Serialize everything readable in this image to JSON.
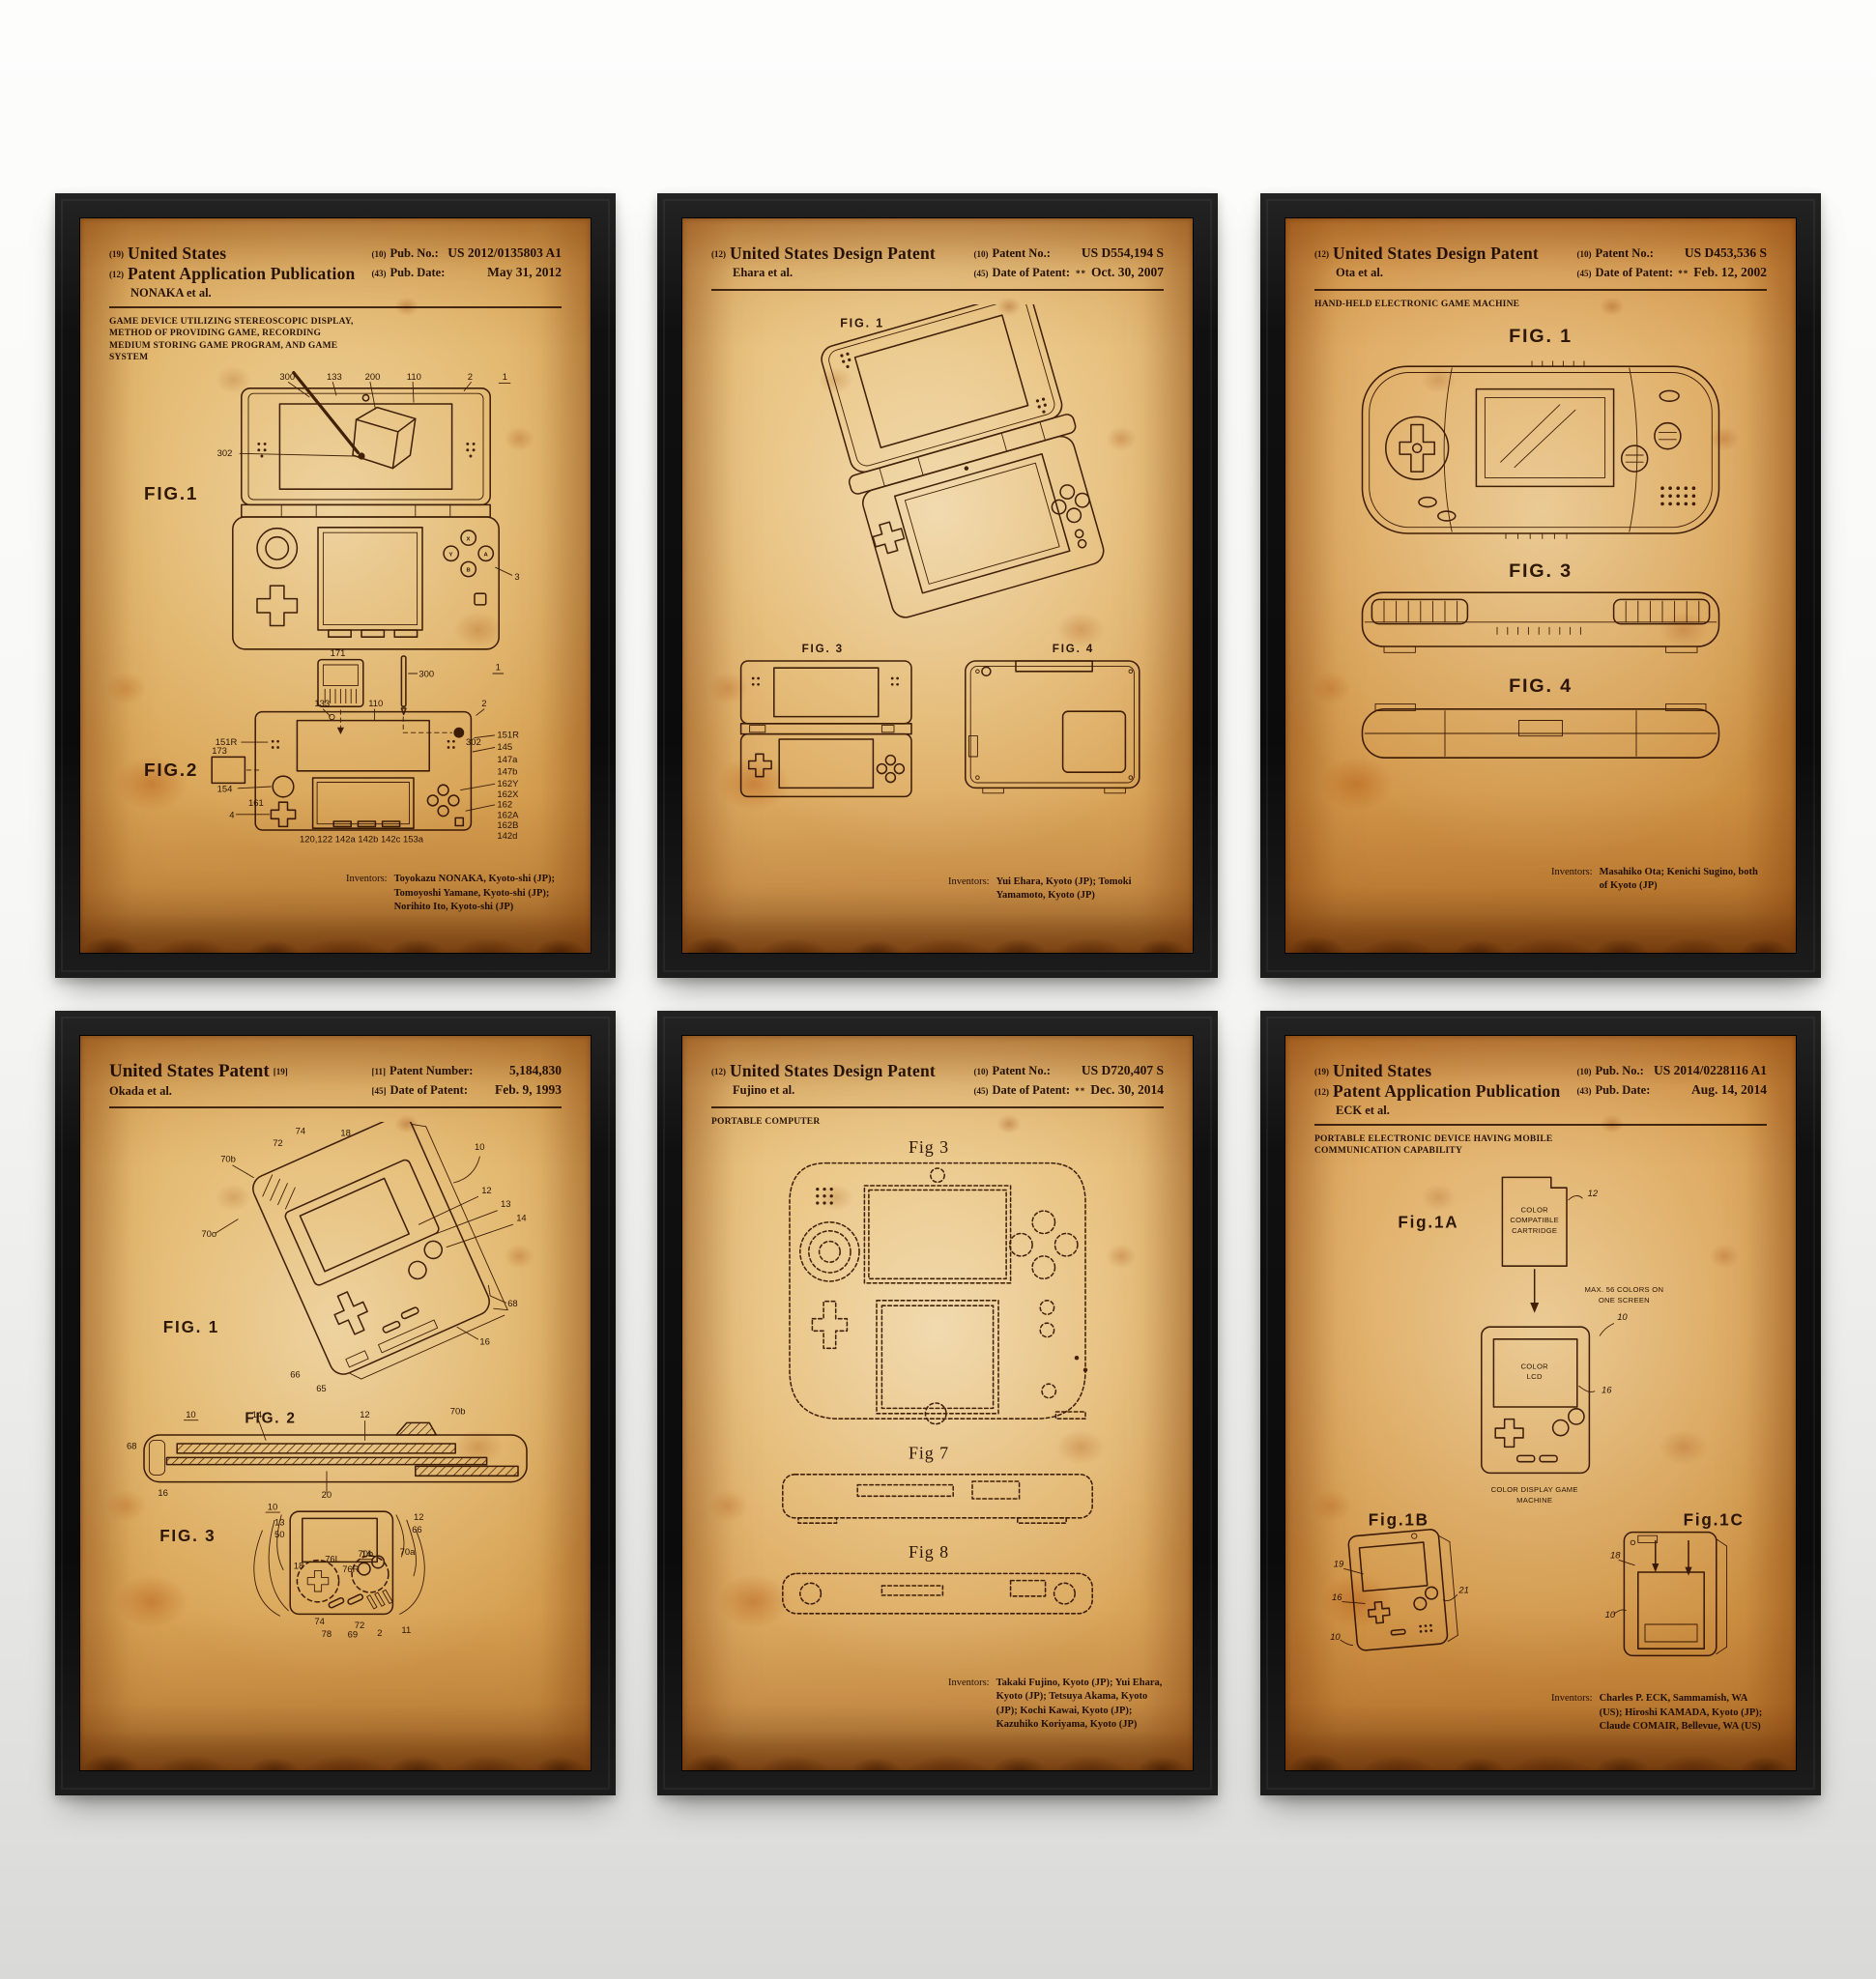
{
  "frames": [
    {
      "name": "nintendo-3ds-patent",
      "header": {
        "n1": "(19)",
        "t1": "United States",
        "n2": "(12)",
        "t2": "Patent Application Publication",
        "party": "NONAKA et al.",
        "rn1": "(10)",
        "rl1": "Pub. No.:",
        "rv1": "US 2012/0135803 A1",
        "rn2": "(43)",
        "rl2": "Pub. Date:",
        "rv2": "May 31, 2012"
      },
      "title": "GAME DEVICE UTILIZING STEREOSCOPIC DISPLAY, METHOD OF PROVIDING GAME, RECORDING MEDIUM STORING GAME PROGRAM, AND GAME SYSTEM",
      "figs": {
        "f1": "FIG.1",
        "f2": "FIG.2"
      },
      "refs": {
        "r300": "300",
        "r133": "133",
        "r200": "200",
        "r110": "110",
        "r2": "2",
        "r1": "1",
        "r302": "302",
        "r3": "3",
        "r171": "171",
        "r173": "173",
        "r161": "161",
        "r154": "154",
        "r4": "4",
        "r151R": "151R",
        "r145": "145",
        "r147a": "147a",
        "r147b": "147b",
        "r162Y": "162Y",
        "r162X": "162X",
        "r162": "162",
        "r162A": "162A",
        "r162B": "162B",
        "r142": "142",
        "r142d": "142d",
        "rrow": "120,122   142a   142b   142c   153a",
        "bx": "X",
        "by": "Y",
        "ba": "A",
        "bb": "B"
      },
      "inv_label": "Inventors:",
      "inventors": "Toyokazu NONAKA, Kyoto-shi (JP); Tomoyoshi Yamane, Kyoto-shi (JP); Norihito Ito, Kyoto-shi (JP)"
    },
    {
      "name": "nintendo-ds-lite-patent",
      "header": {
        "n1": "(12)",
        "t1": "United States Design Patent",
        "party": "Ehara et al.",
        "rn1": "(10)",
        "rl1": "Patent No.:",
        "rv1": "US D554,194 S",
        "rn2": "(45)",
        "rl2": "Date of Patent:",
        "rpre": "**",
        "rv2": "Oct. 30, 2007"
      },
      "figs": {
        "f1": "FIG. 1",
        "f3": "FIG. 3",
        "f4": "FIG. 4"
      },
      "inv_label": "Inventors:",
      "inventors": "Yui Ehara, Kyoto (JP); Tomoki Yamamoto, Kyoto (JP)"
    },
    {
      "name": "game-boy-advance-patent",
      "header": {
        "n1": "(12)",
        "t1": "United States Design Patent",
        "party": "Ota et al.",
        "rn1": "(10)",
        "rl1": "Patent No.:",
        "rv1": "US D453,536 S",
        "rn2": "(45)",
        "rl2": "Date of Patent:",
        "rpre": "**",
        "rv2": "Feb. 12, 2002"
      },
      "title": "HAND-HELD ELECTRONIC GAME MACHINE",
      "figs": {
        "f1": "FIG. 1",
        "f3": "FIG. 3",
        "f4": "FIG. 4"
      },
      "inv_label": "Inventors:",
      "inventors": "Masahiko Ota; Kenichi Sugino, both of Kyoto (JP)"
    },
    {
      "name": "game-boy-patent",
      "header": {
        "t1": "United States Patent",
        "n1": "[19]",
        "party": "Okada et al.",
        "rn1": "[11]",
        "rl1": "Patent Number:",
        "rv1": "5,184,830",
        "rn2": "[45]",
        "rl2": "Date of Patent:",
        "rv2": "Feb. 9, 1993"
      },
      "figs": {
        "f1": "FIG. 1",
        "f2": "FIG. 2",
        "f3": "FIG. 3"
      },
      "refs": {
        "r74": "74",
        "r72": "72",
        "r18": "18",
        "r10": "10",
        "r12": "12",
        "r13": "13",
        "r14": "14",
        "r68": "68",
        "r16": "16",
        "r66": "66",
        "r65": "65",
        "r70b": "70b",
        "r70o": "70o",
        "r20": "20",
        "r50": "50",
        "r76L": "76L",
        "r76R": "76R",
        "r70a": "70a",
        "r78": "78",
        "r69": "69",
        "r2": "2",
        "r11": "11"
      }
    },
    {
      "name": "nintendo-2ds-patent",
      "header": {
        "n1": "(12)",
        "t1": "United States Design Patent",
        "party": "Fujino et al.",
        "rn1": "(10)",
        "rl1": "Patent No.:",
        "rv1": "US D720,407 S",
        "rn2": "(45)",
        "rl2": "Date of Patent:",
        "rpre": "**",
        "rv2": "Dec. 30, 2014"
      },
      "title": "PORTABLE COMPUTER",
      "figs": {
        "f3": "Fig 3",
        "f7": "Fig 7",
        "f8": "Fig 8"
      },
      "inv_label": "Inventors:",
      "inventors": "Takaki Fujino, Kyoto (JP); Yui Ehara, Kyoto (JP); Tetsuya Akama, Kyoto (JP); Kochi Kawai, Kyoto (JP); Kazuhiko Koriyama, Kyoto (JP)"
    },
    {
      "name": "game-boy-color-patent",
      "header": {
        "n1": "(19)",
        "t1": "United States",
        "n2": "(12)",
        "t2": "Patent Application Publication",
        "party": "ECK et al.",
        "rn1": "(10)",
        "rl1": "Pub. No.:",
        "rv1": "US 2014/0228116 A1",
        "rn2": "(43)",
        "rl2": "Pub. Date:",
        "rv2": "Aug. 14, 2014"
      },
      "title": "PORTABLE ELECTRONIC DEVICE HAVING MOBILE COMMUNICATION CAPABILITY",
      "figs": {
        "fA": "Fig.1A",
        "fB": "Fig.1B",
        "fC": "Fig.1C"
      },
      "notes": {
        "cart1": "COLOR",
        "cart2": "COMPATIBLE",
        "cart3": "CARTRIDGE",
        "max1": "MAX. 56 COLORS ON",
        "max2": "ONE SCREEN",
        "lcd1": "COLOR",
        "lcd2": "LCD",
        "mach1": "COLOR DISPLAY GAME",
        "mach2": "MACHINE"
      },
      "refs": {
        "r12": "12",
        "r10": "10",
        "r16": "16",
        "r18": "18",
        "r19": "19",
        "r21": "21"
      },
      "inv_label": "Inventors:",
      "inventors": "Charles P. ECK, Sammamish, WA (US); Hiroshi KAMADA, Kyoto (JP); Claude COMAIR, Bellevue, WA (US)"
    }
  ]
}
